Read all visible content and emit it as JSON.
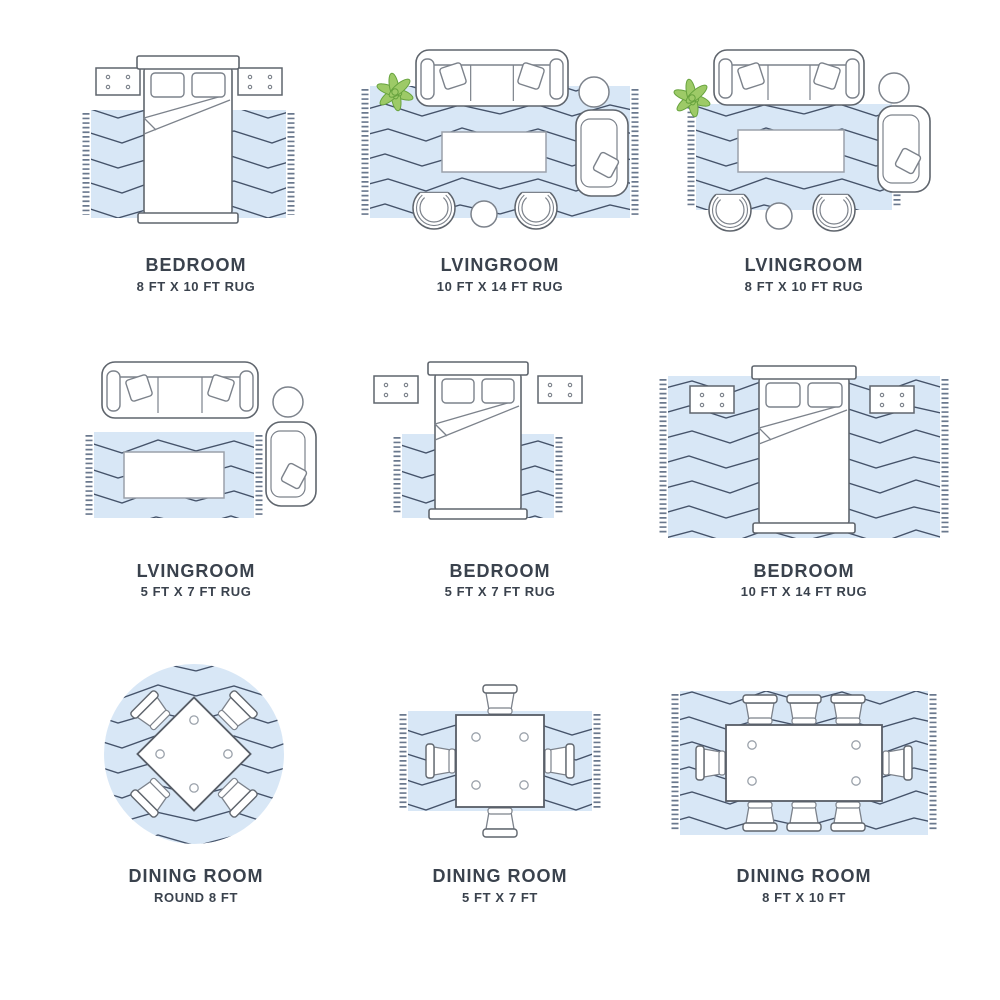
{
  "page": {
    "background": "#ffffff"
  },
  "colors": {
    "rug": "#d8e7f6",
    "zigzag": "#45536a",
    "fringe": "#51617a",
    "furniture_line": "#7c828b",
    "furniture_dark": "#5f656d",
    "soft_line": "#9aa1aa",
    "table_line": "#575d66",
    "plant_fill": "#9dca67",
    "plant_line": "#67a33e",
    "label": "#3a424d"
  },
  "cells": [
    {
      "room": "BEDROOM",
      "size": "8 FT X 10 FT RUG",
      "scene": "bedroom-8x10"
    },
    {
      "room": "LVINGROOM",
      "size": "10 FT X 14 FT RUG",
      "scene": "livingroom-10x14"
    },
    {
      "room": "LVINGROOM",
      "size": "8 FT X 10 FT RUG",
      "scene": "livingroom-8x10"
    },
    {
      "room": "LVINGROOM",
      "size": "5 FT X 7 FT RUG",
      "scene": "livingroom-5x7"
    },
    {
      "room": "BEDROOM",
      "size": "5 FT X 7 FT RUG",
      "scene": "bedroom-5x7"
    },
    {
      "room": "BEDROOM",
      "size": "10 FT X 14 FT RUG",
      "scene": "bedroom-10x14"
    },
    {
      "room": "DINING ROOM",
      "size": "ROUND 8 FT",
      "scene": "dining-round"
    },
    {
      "room": "DINING ROOM",
      "size": "5 FT X 7 FT",
      "scene": "dining-5x7"
    },
    {
      "room": "DINING ROOM",
      "size": "8 FT X 10 FT",
      "scene": "dining-8x10"
    }
  ]
}
